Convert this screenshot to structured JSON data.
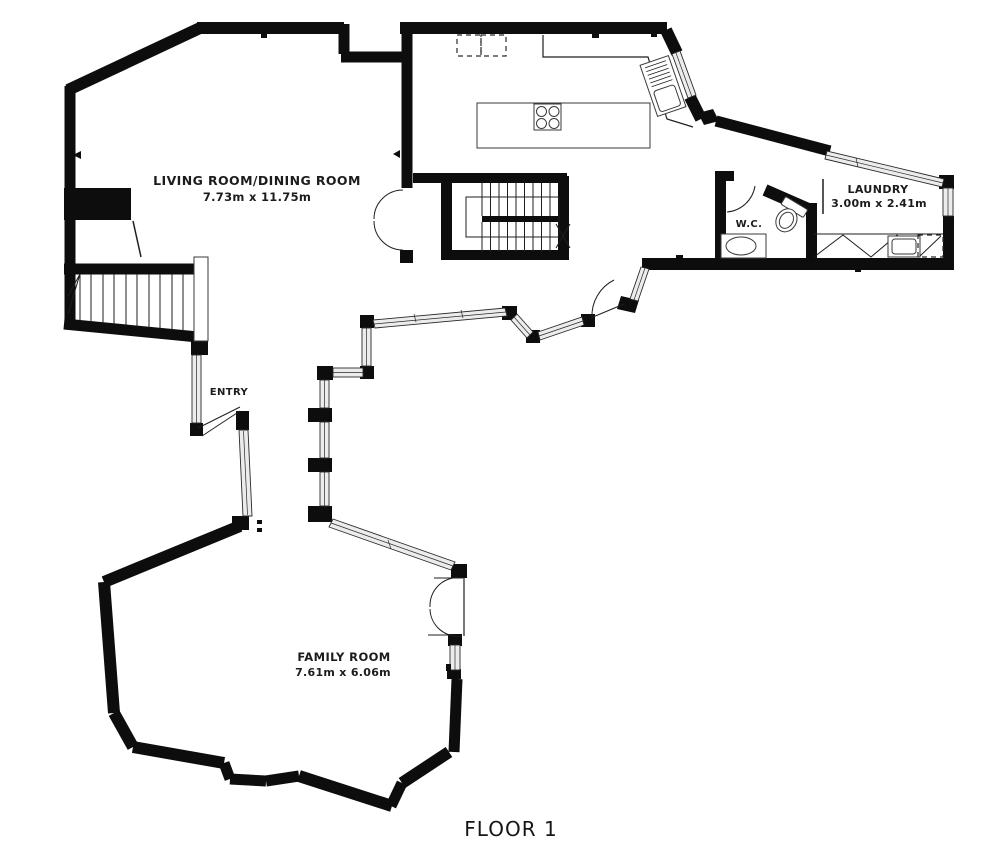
{
  "plan": {
    "floor_label": "FLOOR 1",
    "rooms": {
      "living": {
        "name": "LIVING ROOM/DINING ROOM",
        "dims": "7.73m x 11.75m"
      },
      "laundry": {
        "name": "LAUNDRY",
        "dims": "3.00m x 2.41m"
      },
      "wc": {
        "name": "W.C."
      },
      "entry": {
        "name": "ENTRY"
      },
      "family": {
        "name": "FAMILY ROOM",
        "dims": "7.61m x 6.06m"
      }
    },
    "colors": {
      "wall": "#0d0d0d",
      "background": "#ffffff",
      "window_fill": "#ececec",
      "line": "#2a2a2a",
      "text": "#1c1c1c"
    }
  }
}
